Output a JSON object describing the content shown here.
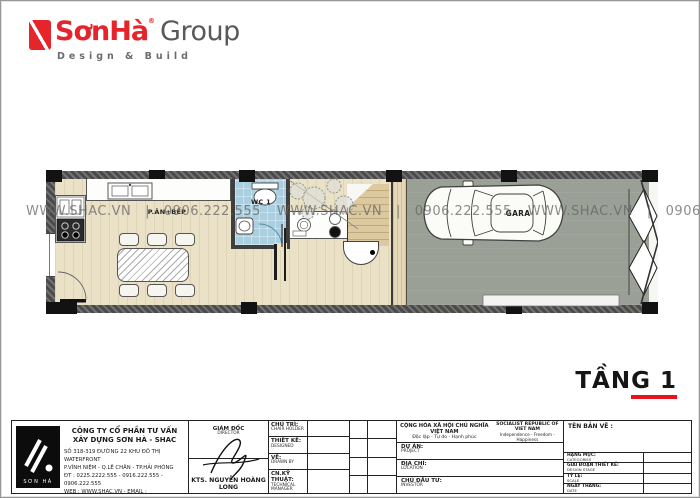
{
  "brand": {
    "name_primary": "SơnHà",
    "reg_mark": "®",
    "name_secondary": "Group",
    "tagline": "Design & Build"
  },
  "plan": {
    "watermark_unit": "WWW.SHAC.VN   |   0906.222.555",
    "rooms": {
      "kitchen": "P.ĂN+BẾP",
      "wc": "WC 1",
      "garage": "GARA"
    },
    "floor_label": "TẦNG 1"
  },
  "titleblock": {
    "company": {
      "logo_text": "SƠN HÀ",
      "name_line1": "CÔNG TY CỔ PHẦN TƯ VẤN",
      "name_line2": "XÂY DỰNG SƠN HÀ - SHAC",
      "address_line1": "SỐ 318-319 ĐƯỜNG 22 KHU ĐÔ THỊ WATERFRONT",
      "address_line2": "P.VĨNH NIỆM - Q.LÊ CHÂN - TP.HẢI PHÒNG",
      "phone_line": "ĐT : 0225.2222.555 - 0916.222.555 - 0906.222.555",
      "web_line": "WEB : WWW.SHAC.VN - EMAIL : SONHA@SHAC.VN"
    },
    "director": {
      "title_vn": "GIÁM ĐỐC",
      "title_en": "DIRECTOR",
      "name": "KTS. NGUYỄN HOÀNG LONG"
    },
    "personnel_rows": [
      {
        "label_vn": "CHỦ TRÌ:",
        "label_en": "CHAIR HOLDER"
      },
      {
        "label_vn": "THIẾT KẾ:",
        "label_en": "DESIGNED"
      },
      {
        "label_vn": "VẼ:",
        "label_en": "DRAWN BY"
      },
      {
        "label_vn": "CN.KỸ THUẬT:",
        "label_en": "TECHNICAL MANAGER"
      }
    ],
    "national": {
      "motto_vn_line1": "CỘNG HÒA XÃ HỘI CHỦ NGHĨA VIỆT NAM",
      "motto_vn_line2": "Độc lập - Tự do - Hạnh phúc",
      "motto_en_line1": "SOCIALIST REPUBLIC OF VIET NAM",
      "motto_en_line2": "Independence - Freedom - Happiness"
    },
    "project_rows": [
      {
        "label_vn": "DỰ ÁN:",
        "label_en": "PROJECT"
      },
      {
        "label_vn": "ĐỊA CHỈ:",
        "label_en": "LOCATION"
      },
      {
        "label_vn": "CHỦ ĐẦU TƯ:",
        "label_en": "INVESTOR"
      }
    ],
    "drawing": {
      "title_label": "TÊN BẢN VẼ :",
      "meta_rows": [
        {
          "label_vn": "HẠNG MỤC:",
          "label_en": "CATEGORIES"
        },
        {
          "label_vn": "GIAI ĐOẠN THIẾT KẾ:",
          "label_en": "DESIGN STAGE"
        },
        {
          "label_vn": "TỶ LỆ:",
          "label_en": "SCALE"
        },
        {
          "label_vn": "NGÀY THÁNG:",
          "label_en": "DATE"
        }
      ]
    }
  },
  "colors": {
    "brand_red": "#E5242B",
    "underline_red": "#E8141C",
    "wc_blue": "#AACFE0",
    "floor_beige": "#EAE1C7",
    "garage_gray": "#9BA096",
    "wall_dark": "#4A4A4A"
  }
}
